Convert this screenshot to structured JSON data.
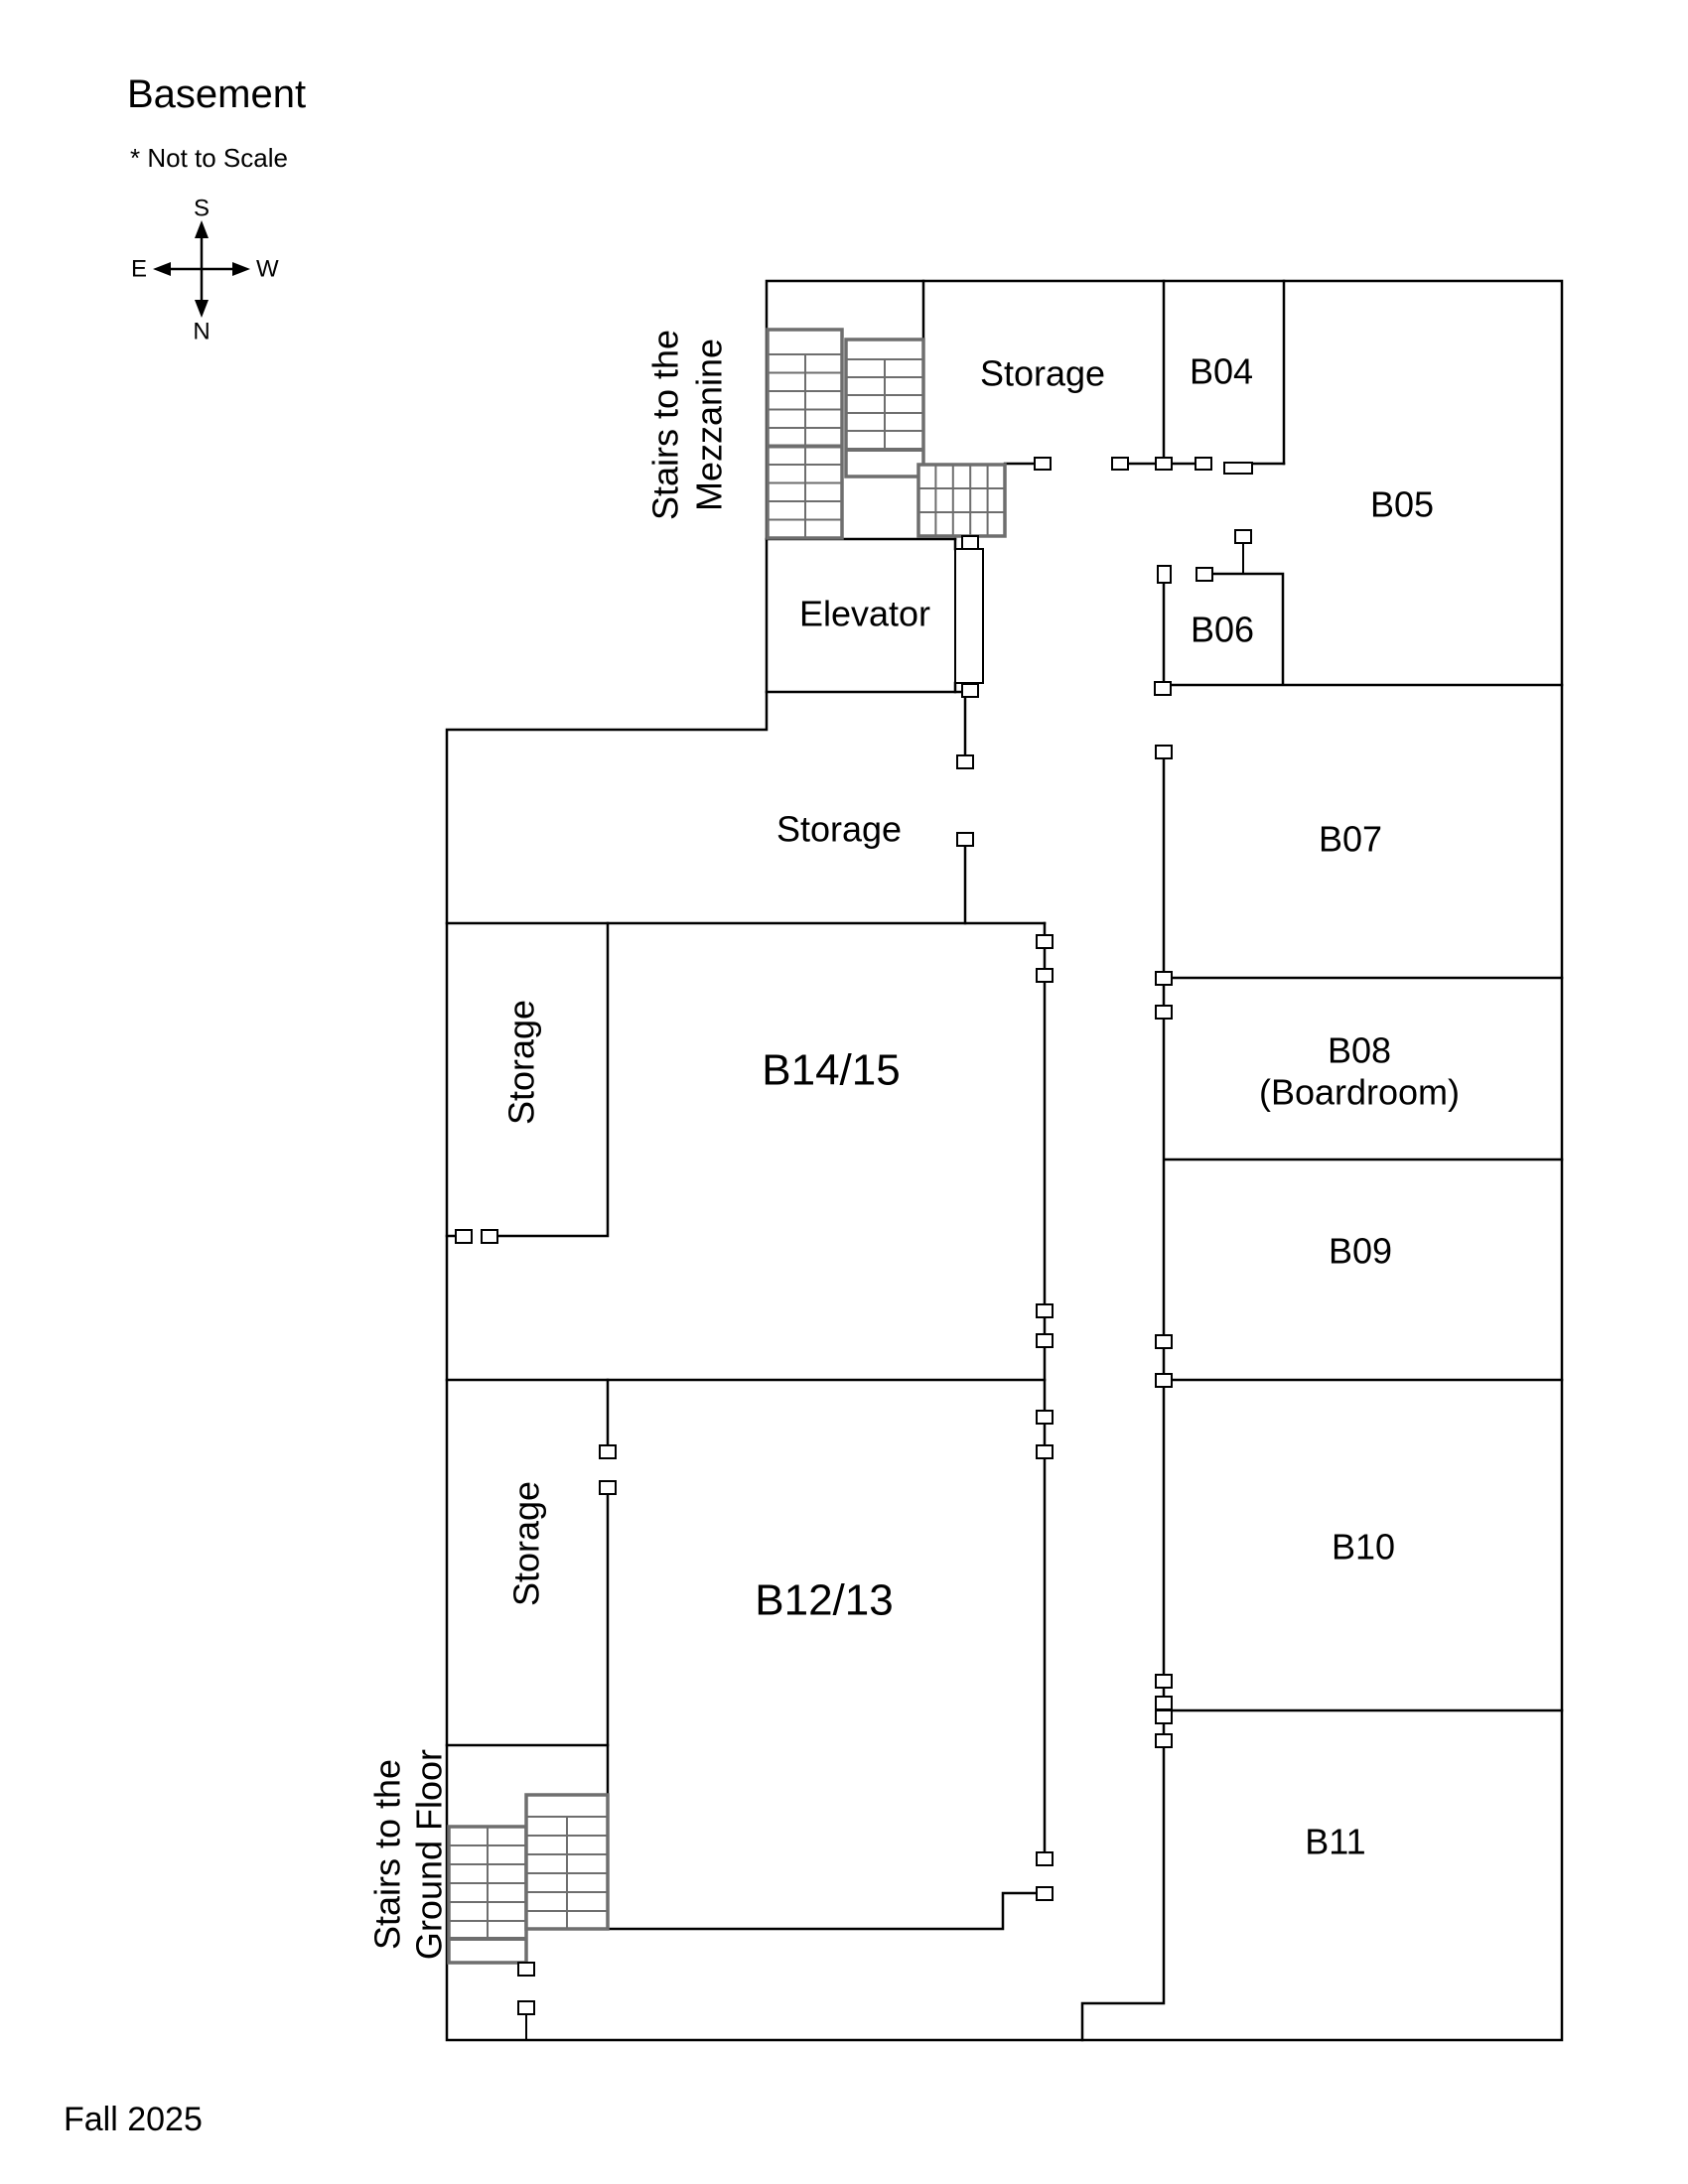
{
  "title": "Basement",
  "scale_note": "* Not to Scale",
  "footer": "Fall 2025",
  "compass": {
    "top": "S",
    "bottom": "N",
    "left": "E",
    "right": "W"
  },
  "colors": {
    "walls": "#000000",
    "stairs": "#6e6e6e",
    "background": "#ffffff"
  },
  "labels": {
    "stairs_mezzanine_line1": "Stairs to the",
    "stairs_mezzanine_line2": "Mezzanine",
    "stairs_ground_line1": "Stairs to the",
    "stairs_ground_line2": "Ground Floor",
    "storage_top": "Storage",
    "storage_mid": "Storage",
    "storage_b1415": "Storage",
    "storage_b1213": "Storage",
    "elevator": "Elevator",
    "b04": "B04",
    "b05": "B05",
    "b06": "B06",
    "b07": "B07",
    "b08_line1": "B08",
    "b08_line2": "(Boardroom)",
    "b09": "B09",
    "b10": "B10",
    "b11": "B11",
    "b1415": "B14/15",
    "b1213": "B12/13"
  }
}
